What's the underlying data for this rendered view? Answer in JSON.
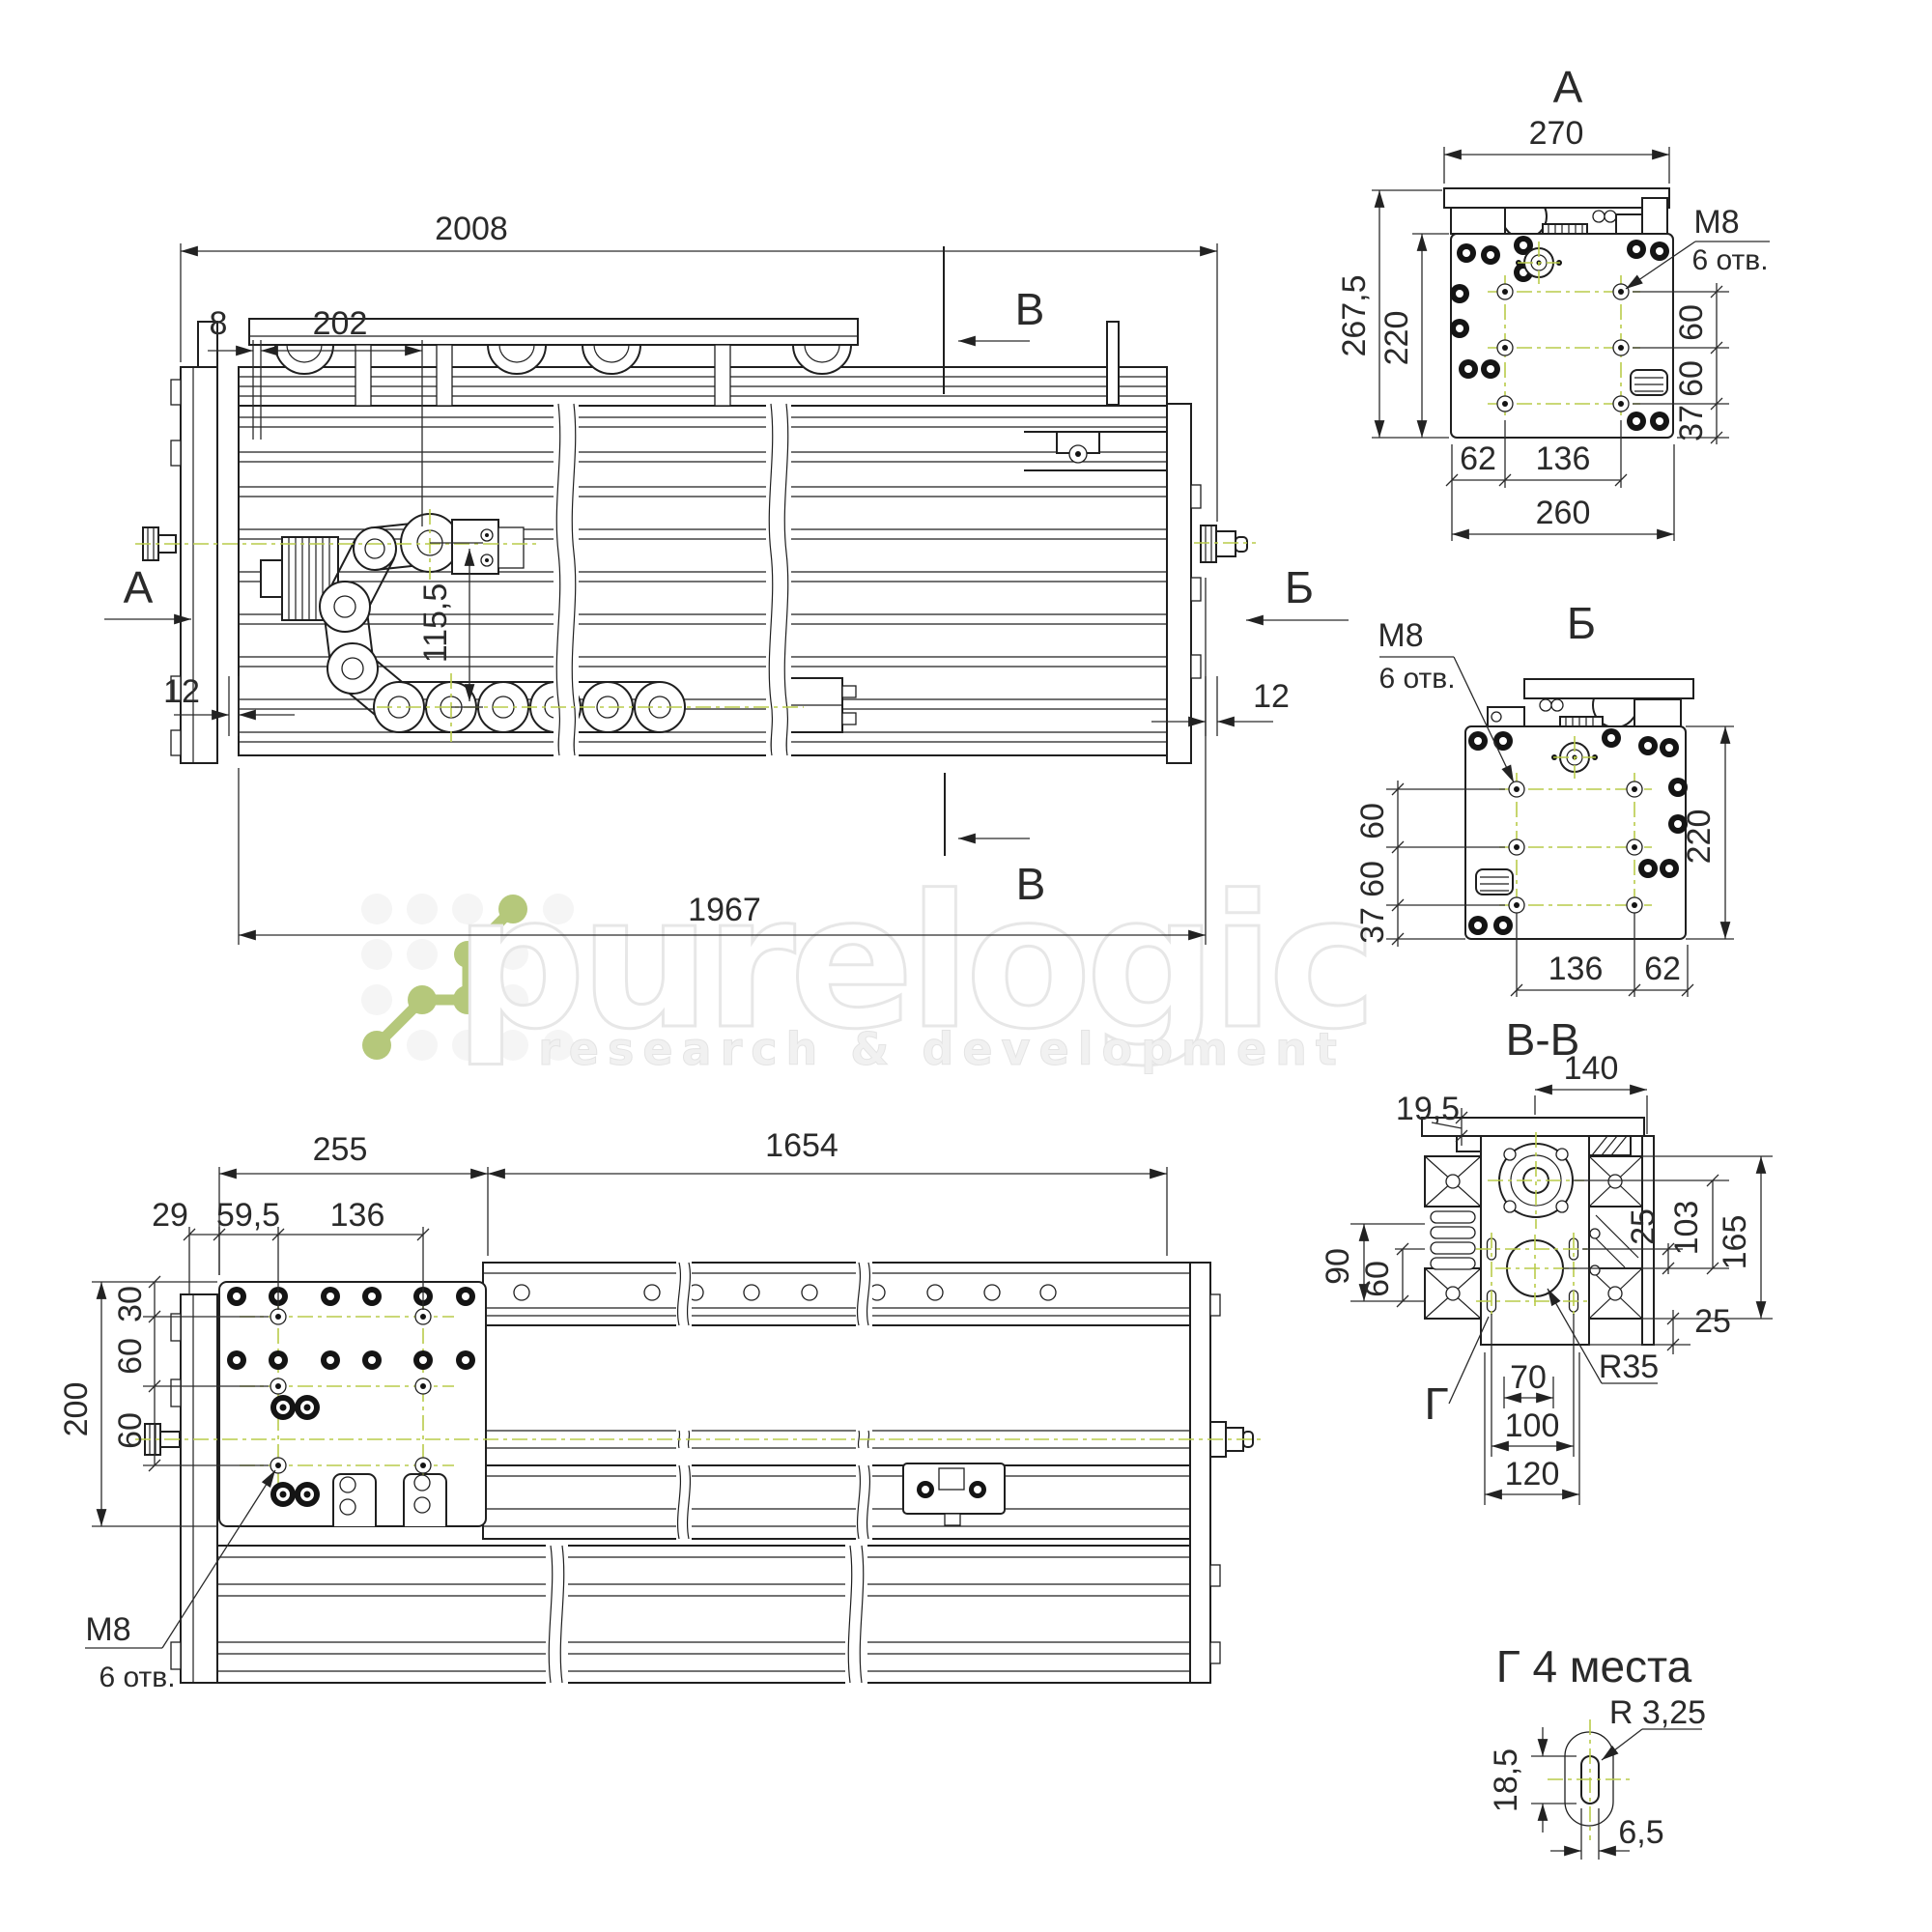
{
  "waterm": {
    "brand": "purelogic",
    "tagline": "research & development"
  },
  "labels": {
    "viewA": "А",
    "viewB": "Б",
    "secV": "В",
    "secVV": "В-В",
    "g": "Г",
    "g4": "Г 4 места",
    "m8": "M8",
    "otv": "6 отв."
  },
  "dims": {
    "d2008": "2008",
    "d8": "8",
    "d202": "202",
    "d115_5": "115,5",
    "d12": "12",
    "d1967": "1967",
    "d270": "270",
    "d267_5": "267,5",
    "d220": "220",
    "d60": "60",
    "d37": "37",
    "d62": "62",
    "d136": "136",
    "d260": "260",
    "d255": "255",
    "d1654": "1654",
    "d29": "29",
    "d59_5": "59,5",
    "d30": "30",
    "d200": "200",
    "d140": "140",
    "d19_5": "19,5",
    "d25": "25",
    "d103": "103",
    "d165": "165",
    "d90": "90",
    "d70": "70",
    "d100": "100",
    "d120": "120",
    "r35": "R35",
    "r3_25": "R 3,25",
    "d18_5": "18,5",
    "d6_5": "6,5"
  },
  "colors": {
    "line": "#1f1f1f",
    "centerline": "#b9cb4a",
    "logo_green": "#b5c87b"
  }
}
